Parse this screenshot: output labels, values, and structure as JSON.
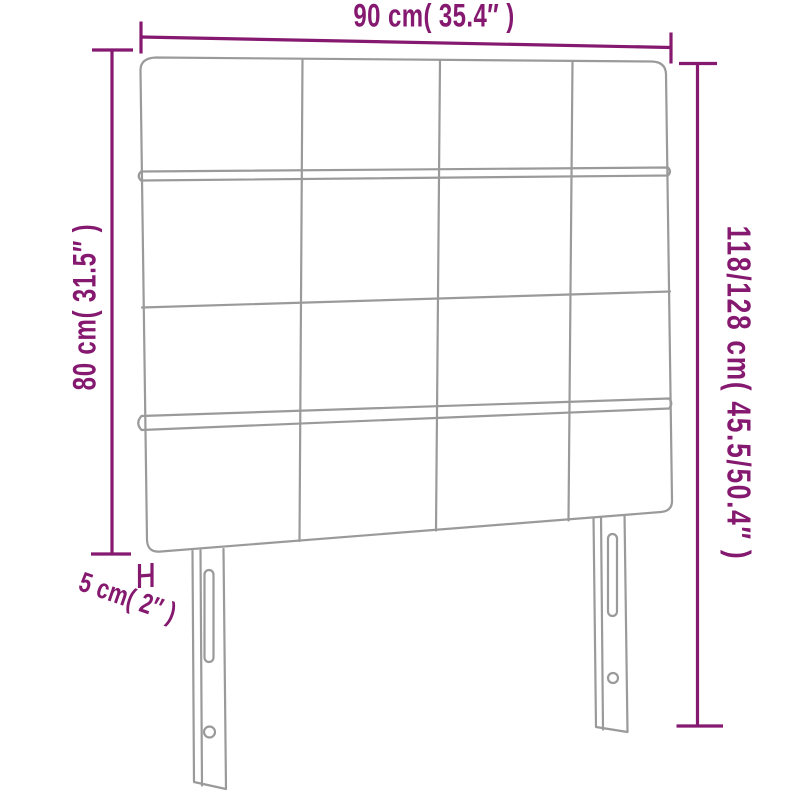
{
  "diagram": {
    "kind": "headboard-dimension-diagram",
    "labels": {
      "width": "90 cm( 35.4″ )",
      "height_left": "80 cm( 31.5″ )",
      "height_right": "118/128 cm( 45.5/50.4″ )",
      "thickness": "5 cm( 2″ )"
    },
    "colors": {
      "dimension_line": "#85186F",
      "outline_gray": "#9A9A9A",
      "background": "#FFFFFF"
    }
  }
}
